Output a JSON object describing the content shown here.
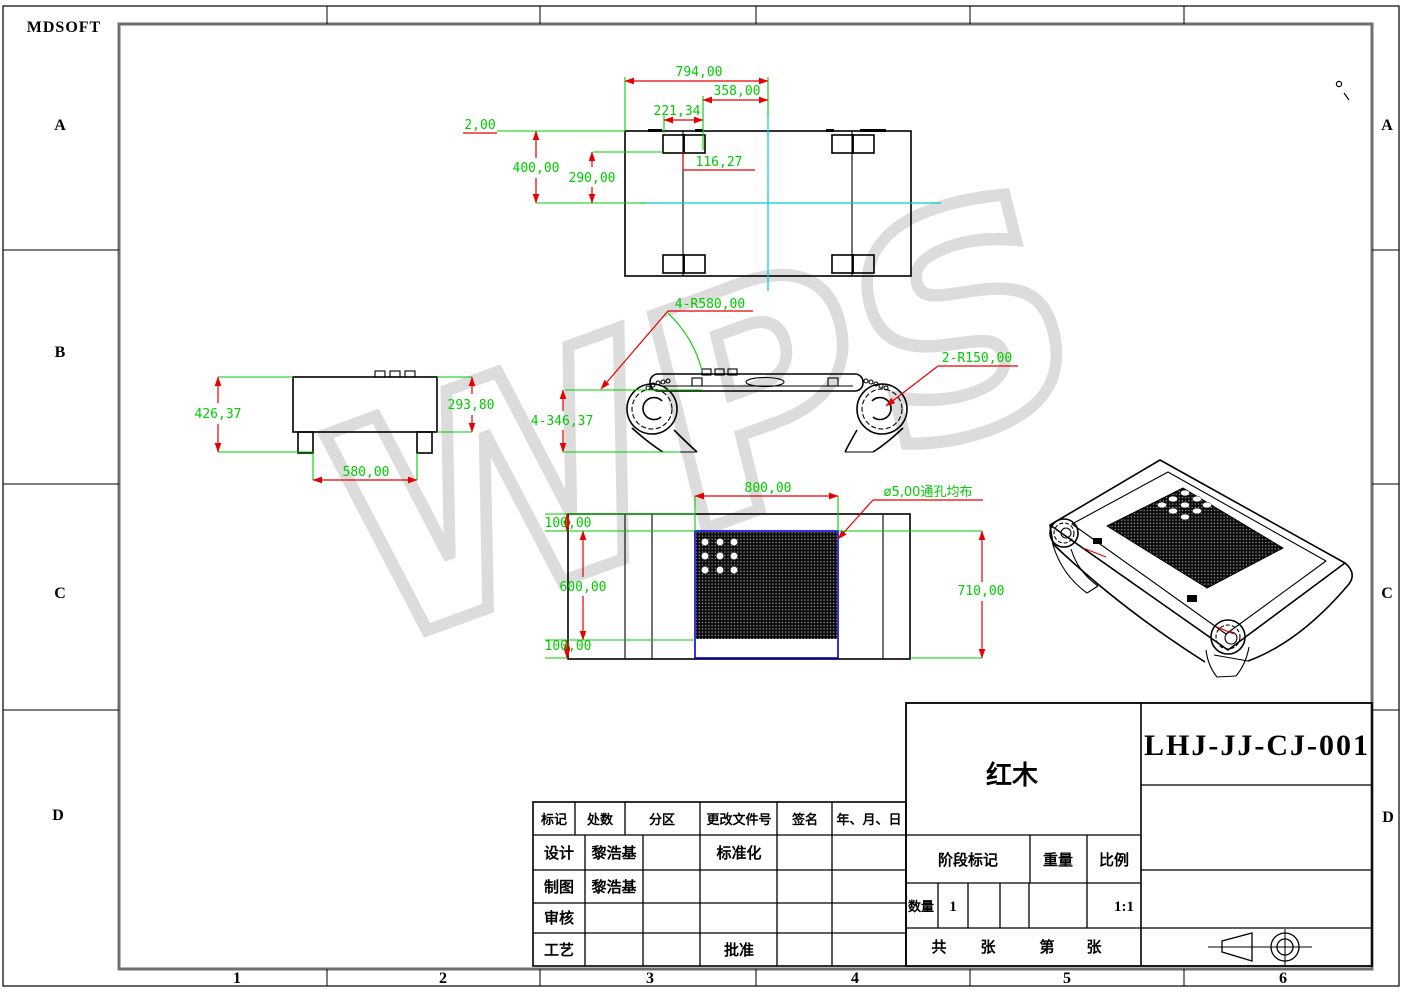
{
  "sheet": {
    "logo": "MDSOFT",
    "zones_left": [
      "A",
      "B",
      "C",
      "D"
    ],
    "zones_right": [
      "A",
      "C",
      "D"
    ],
    "col_numbers": [
      "1",
      "2",
      "3",
      "4",
      "5",
      "6"
    ]
  },
  "watermark": "WPS",
  "colors": {
    "dim_green": "#00cc00",
    "dim_red": "#e60000",
    "centerline_cyan": "#00cccc",
    "mesh_blue": "#0000dd"
  },
  "views": {
    "top_view": {
      "dim_794": "794,00",
      "dim_358": "358,00",
      "dim_221": "221,34",
      "dim_2": "2,00",
      "dim_400": "400,00",
      "dim_290": "290,00",
      "dim_116": "116,27"
    },
    "front_view": {
      "dim_426": "426,37",
      "dim_293": "293,80",
      "dim_580": "580,00"
    },
    "side_view": {
      "dim_r580": "4-R580,00",
      "dim_r150": "2-R150,00",
      "dim_346": "4-346,37"
    },
    "plan_view": {
      "dim_800": "800,00",
      "dim_hole": "ø5,00通孔均布",
      "dim_100_top": "100,00",
      "dim_600": "600,00",
      "dim_100_bottom": "100,00",
      "dim_710": "710,00"
    }
  },
  "title_block": {
    "rev_headers": [
      "标记",
      "处数",
      "分区",
      "更改文件号",
      "签名",
      "年、月、日"
    ],
    "design_label": "设计",
    "design_name": "黎浩基",
    "draft_label": "制图",
    "draft_name": "黎浩基",
    "check_label": "审核",
    "process_label": "工艺",
    "standard_label": "标准化",
    "approve_label": "批准",
    "part_name": "红木",
    "drawing_no": "LHJ-JJ-CJ-001",
    "stage_label": "阶段标记",
    "weight_label": "重量",
    "scale_label": "比例",
    "qty_label": "数量",
    "qty_value": "1",
    "scale_value": "1:1",
    "sheet_total_label": "共",
    "sheet_unit_1": "张",
    "sheet_no_label": "第",
    "sheet_unit_2": "张"
  }
}
